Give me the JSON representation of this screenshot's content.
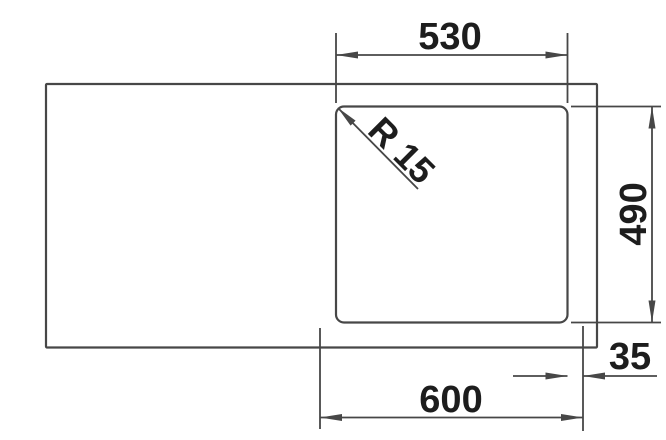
{
  "drawing": {
    "dimensions": {
      "cutout_width": {
        "label": "530"
      },
      "cutout_height": {
        "label": "490"
      },
      "overall_width": {
        "label": "600"
      },
      "right_offset": {
        "label": "35"
      },
      "corner_radius": {
        "label": "R 15"
      }
    },
    "colors": {
      "line": "#474747",
      "text": "#1d1d1d",
      "background": "#ffffff"
    }
  }
}
